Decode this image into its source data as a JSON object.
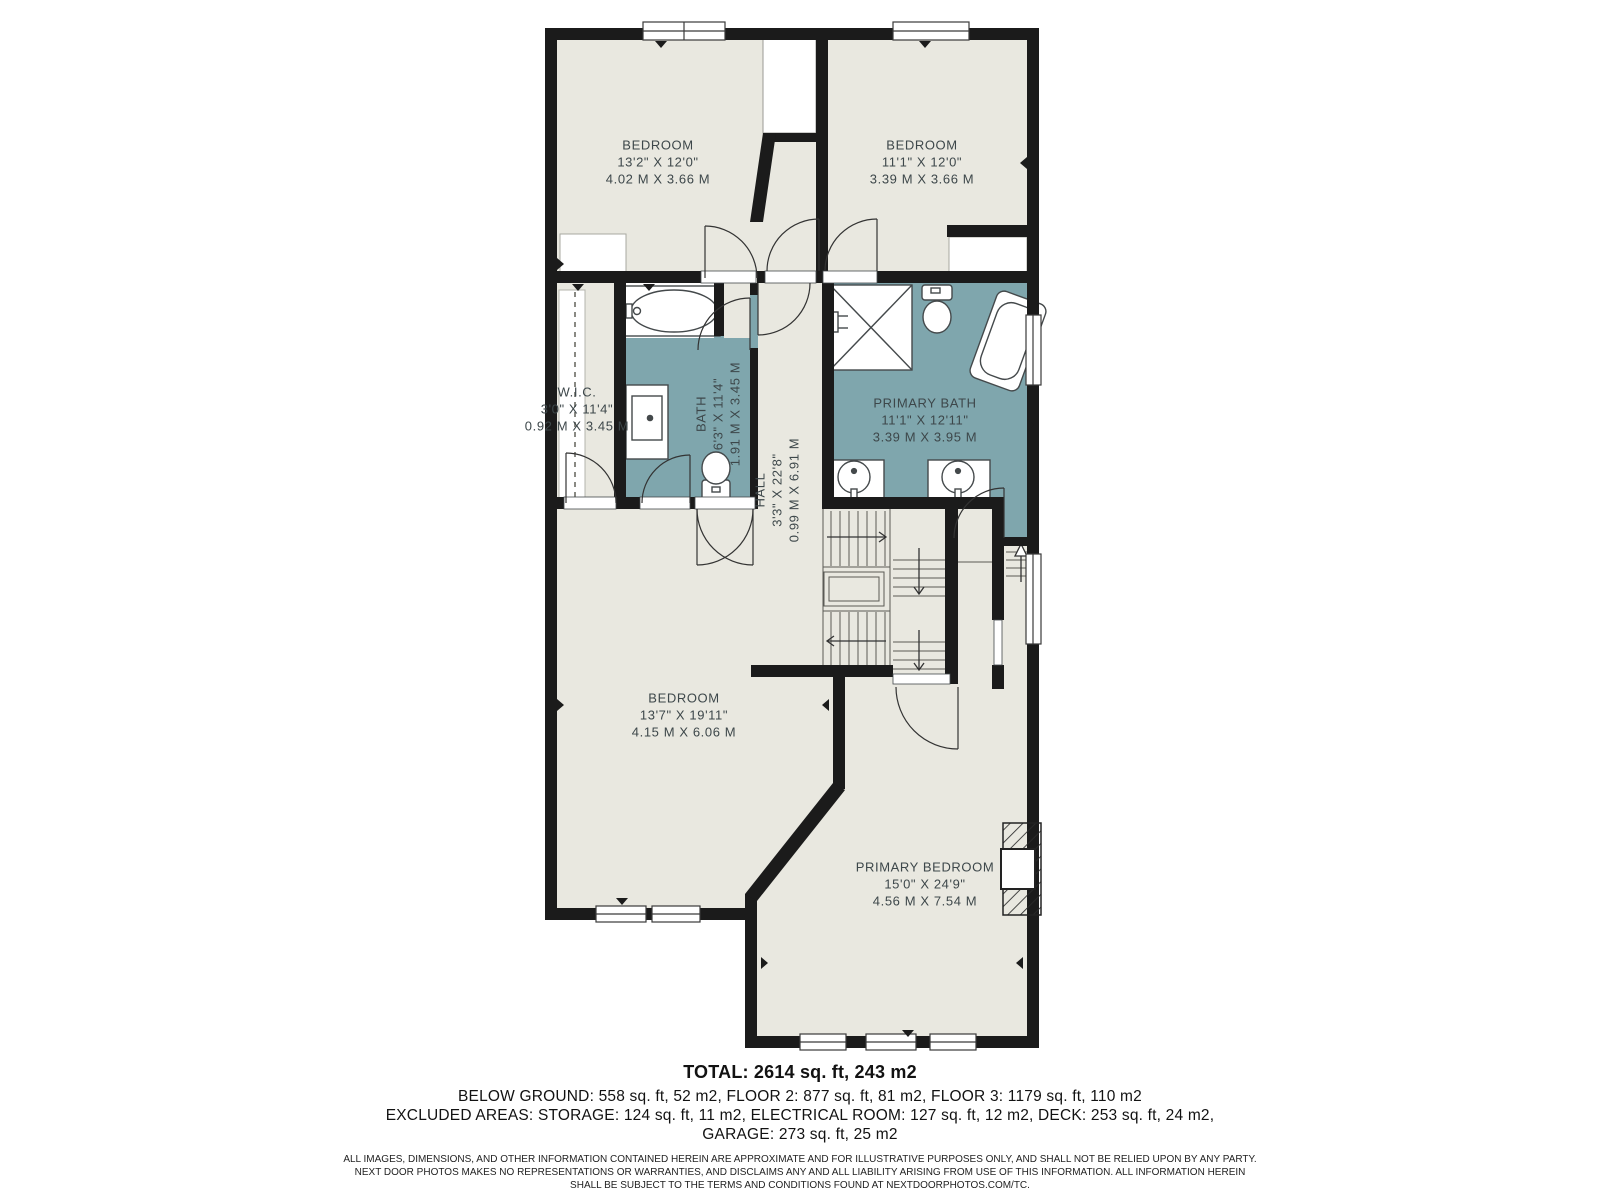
{
  "colors": {
    "floor": "#e9e8e0",
    "wet_room_floor": "#7fa6ad",
    "wall": "#1b1b1b",
    "room_label_text": "#3d474a"
  },
  "rooms": [
    {
      "id": "bedroom-top-left",
      "name": "BEDROOM",
      "imperial": "13'2\" X 12'0\"",
      "metric": "4.02 M X 3.66 M"
    },
    {
      "id": "bedroom-top-right",
      "name": "BEDROOM",
      "imperial": "11'1\" X 12'0\"",
      "metric": "3.39 M X 3.66 M"
    },
    {
      "id": "walk-in-closet",
      "name": "W.I.C.",
      "imperial": "3'0\" X 11'4\"",
      "metric": "0.92 M X 3.45 M"
    },
    {
      "id": "bath",
      "name": "BATH",
      "imperial": "6'3\" X 11'4\"",
      "metric": "1.91 M X 3.45 M"
    },
    {
      "id": "hall",
      "name": "HALL",
      "imperial": "3'3\" X 22'8\"",
      "metric": "0.99 M X 6.91 M"
    },
    {
      "id": "primary-bath",
      "name": "PRIMARY BATH",
      "imperial": "11'1\" X 12'11\"",
      "metric": "3.39 M X 3.95 M"
    },
    {
      "id": "bedroom-lower-left",
      "name": "BEDROOM",
      "imperial": "13'7\" X 19'11\"",
      "metric": "4.15 M X 6.06 M"
    },
    {
      "id": "primary-bedroom",
      "name": "PRIMARY BEDROOM",
      "imperial": "15'0\" X 24'9\"",
      "metric": "4.56 M X 7.54 M"
    }
  ],
  "summary": {
    "total": "TOTAL: 2614 sq. ft, 243 m2",
    "line1": "BELOW GROUND: 558 sq. ft, 52 m2, FLOOR 2: 877 sq. ft, 81 m2, FLOOR 3: 1179 sq. ft, 110 m2",
    "line2": "EXCLUDED AREAS: STORAGE: 124 sq. ft, 11 m2, ELECTRICAL ROOM: 127 sq. ft, 12 m2, DECK: 253 sq. ft, 24 m2,",
    "line3": "GARAGE: 273 sq. ft, 25 m2"
  },
  "disclaimer": {
    "line1": "ALL IMAGES, DIMENSIONS, AND OTHER INFORMATION CONTAINED HEREIN ARE APPROXIMATE AND FOR ILLUSTRATIVE PURPOSES ONLY, AND SHALL NOT BE RELIED UPON BY ANY PARTY.",
    "line2": "NEXT DOOR PHOTOS MAKES NO REPRESENTATIONS OR WARRANTIES, AND DISCLAIMS ANY AND ALL LIABILITY ARISING FROM USE OF THIS INFORMATION. ALL INFORMATION HEREIN",
    "line3": "SHALL BE SUBJECT TO THE TERMS AND CONDITIONS FOUND AT NEXTDOORPHOTOS.COM/TC."
  }
}
